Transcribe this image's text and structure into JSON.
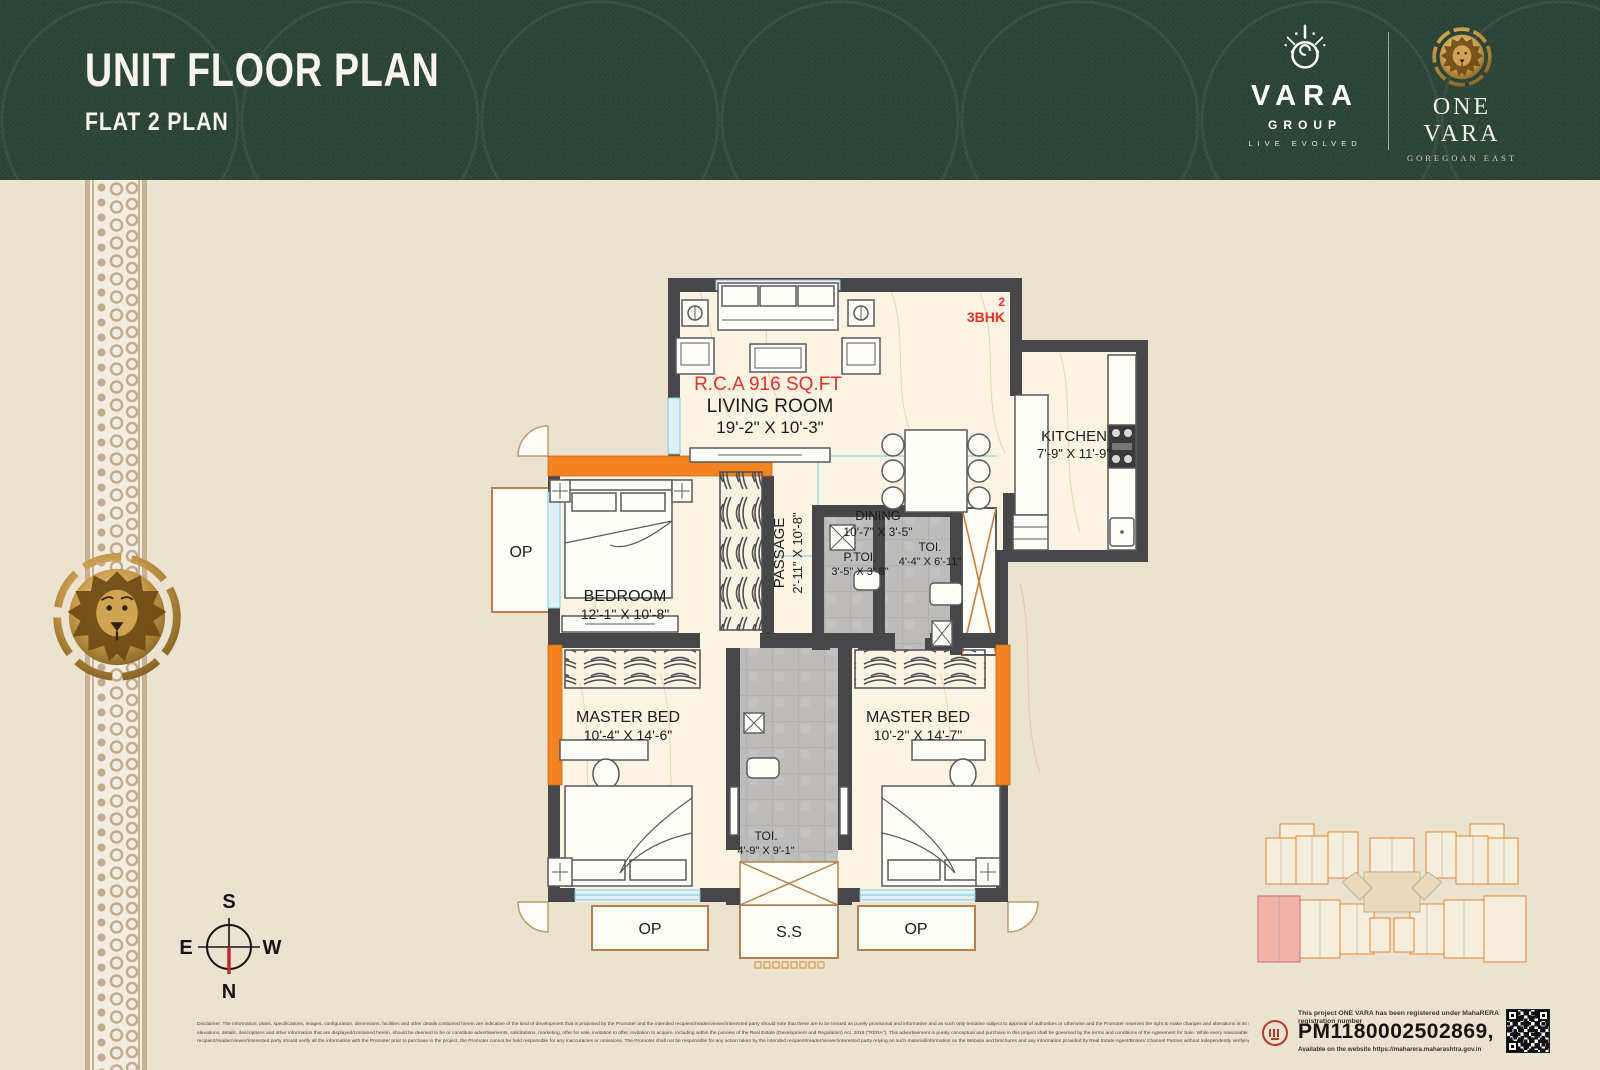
{
  "header": {
    "title": "UNIT FLOOR PLAN",
    "subtitle": "FLAT 2 PLAN",
    "vara_logo": {
      "name": "VARA",
      "group": "GROUP",
      "tagline": "LIVE EVOLVED"
    },
    "onevara_logo": {
      "name": "ONE VARA",
      "place": "GOREGOAN EAST"
    }
  },
  "plan": {
    "unit_number": "2",
    "unit_type": "3BHK",
    "area_label": "R.C.A 916 SQ.FT",
    "rooms": {
      "living": {
        "name": "LIVING ROOM",
        "dim": "19'-2\" X 10'-3\""
      },
      "dining": {
        "name": "DINING",
        "dim": "10'-7\" X 3'-5\""
      },
      "kitchen": {
        "name": "KITCHEN",
        "dim": "7'-9\" X 11'-9\""
      },
      "passage": {
        "name": "PASSAGE",
        "dim": "2'-11\" X 10'-8\""
      },
      "bedroom": {
        "name": "BEDROOM",
        "dim": "12'-1\" X 10'-8\""
      },
      "p_toilet": {
        "name": "P.TOI.",
        "dim": "3'-5\" X 3'-8\""
      },
      "toilet1": {
        "name": "TOI.",
        "dim": "4'-4\" X 6'-11\""
      },
      "master1": {
        "name": "MASTER BED",
        "dim": "10'-4\" X 14'-6\""
      },
      "master2": {
        "name": "MASTER BED",
        "dim": "10'-2\" X 14'-7\""
      },
      "toilet2": {
        "name": "TOI.",
        "dim": "4'-9\" X 9'-1\""
      }
    },
    "op_label": "OP",
    "ss_label": "S.S"
  },
  "compass": {
    "n": "N",
    "s": "S",
    "e": "E",
    "w": "W"
  },
  "footer": {
    "disclaimer_line1": "Disclaimer: The information, plans, specifications, images, configuration, dimensions, facilities and other details contained herein are indicative of the kind of development that is proposed by the Promoter and the intended recipient/reader/viewer/interested party should note that these are to be treated as purely provisional and informative and as such only tentative subject to approval of authorities or otherwise and the Promoter reserves the right to make changes and alterations at its sole discretion. None of the images, material, stock photography, projections,",
    "disclaimer_line2": "elevations, details, descriptions and other information that are displayed/contained herein, should be deemed to be or constitute advertisements, solicitations, marketing, offer for sale, invitation to offer, invitation to acquire, including within the purview of the Real Estate (Development and Regulation) Act, 2016 (\"RERA\"). This advertisement is purely conceptual and purchase in this project shall be governed by the terms and conditions of the Agreement for Sale. While every reasonable care has been taken in fashioning this advertisement, Any intended",
    "disclaimer_line3": "recipient/reader/viewer/interested party should verify all the information with the Promoter prior to purchase in the project, the Promoter cannot be held responsible for any inaccuracies or omissions. The Promoter shall not be responsible for any action taken by the intended recipient/reader/viewer/interested party relying on such material/information on the Website and brochures and any information provided by Real Estate Agent/Broker/ Channel Partner without independently verifying with the Promoter. *T&C Apply",
    "rera": {
      "intro": "This project ONE VARA has been registered under MahaRERA registration number",
      "number": "PM1180002502869,",
      "website": "Available on the website https://maharera.maharashtra.gov.in"
    }
  },
  "colors": {
    "header_green": "#2c4637",
    "background_beige": "#ece2d0",
    "accent_orange": "#f58220",
    "wall_grey": "#47474a",
    "brand_gold": "#c79b4a",
    "highlight_red": "#e53128"
  }
}
